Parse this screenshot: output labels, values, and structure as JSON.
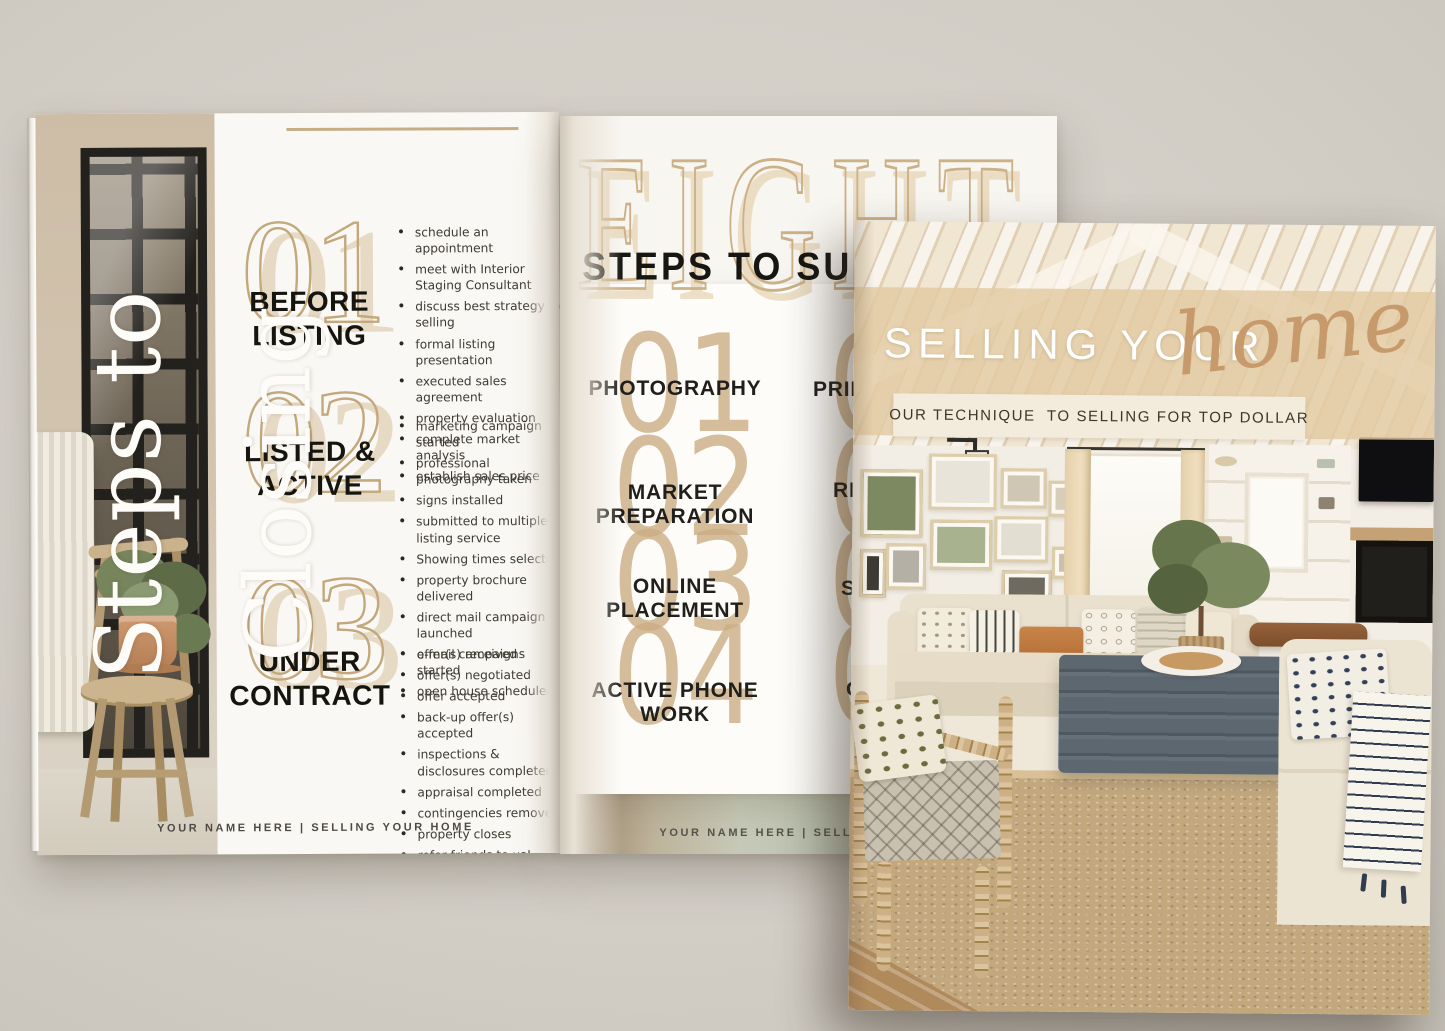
{
  "scene": {
    "background_color": "#d2cec6",
    "accent_tan": "#c9ad85",
    "page_white": "#f8f6f2",
    "text_black": "#1d1c1a"
  },
  "left_page": {
    "vertical_title": "Steps to Closing",
    "footer": "YOUR NAME HERE | SELLING YOUR HOME",
    "sections": [
      {
        "number": "01",
        "title": "BEFORE LISTING",
        "bullets": [
          "schedule an appointment",
          "meet with Interior Staging Consultant",
          "discuss best strategy for selling",
          "formal listing presentation",
          "executed sales agreement",
          "property evaluation",
          "complete market analysis",
          "establish sales price"
        ]
      },
      {
        "number": "02",
        "title": "LISTED & ACTIVE",
        "bullets": [
          "marketing campaign started",
          "professional photography taken",
          "signs installed",
          "submitted to multiple listing service",
          "Showing times selected",
          "property brochure delivered",
          "direct mail campaign launched",
          "e-mail campaigns started",
          "open house scheduled"
        ]
      },
      {
        "number": "03",
        "title": "UNDER CONTRACT",
        "bullets": [
          "offer(s) received",
          "offer(s) negotiated",
          "offer accepted",
          "back-up offer(s) accepted",
          "inspections & disclosures completed",
          "appraisal completed",
          "contingencies removed",
          "property closes",
          "refer friends to us!"
        ]
      }
    ]
  },
  "right_page": {
    "headline": "EIGHT",
    "subheadline_visible": "STEPS TO SU",
    "steps": [
      {
        "number": "01",
        "label": "PHOTOGRAPHY"
      },
      {
        "number": "02",
        "label": "MARKET PREPARATION"
      },
      {
        "number": "03",
        "label": "ONLINE PLACEMENT"
      },
      {
        "number": "04",
        "label": "ACTIVE PHONE WORK"
      }
    ],
    "steps_partial": [
      {
        "number": "05",
        "label_visible": "PRINT"
      },
      {
        "number": "06",
        "label_visible": "RES"
      },
      {
        "number": "07",
        "label_visible": "SO"
      },
      {
        "number": "08",
        "label_visible": "OF"
      }
    ],
    "footer_visible": "YOUR NAME HERE | SELLING YOU"
  },
  "cover": {
    "title": "SELLING YOUR",
    "title_script": "home",
    "tagline": "OUR TECHNIQUE  TO SELLING FOR TOP DOLLAR",
    "band_color": "#e2c9a1",
    "bar_color": "#f3ecdc",
    "script_color": "#c79a6c"
  }
}
